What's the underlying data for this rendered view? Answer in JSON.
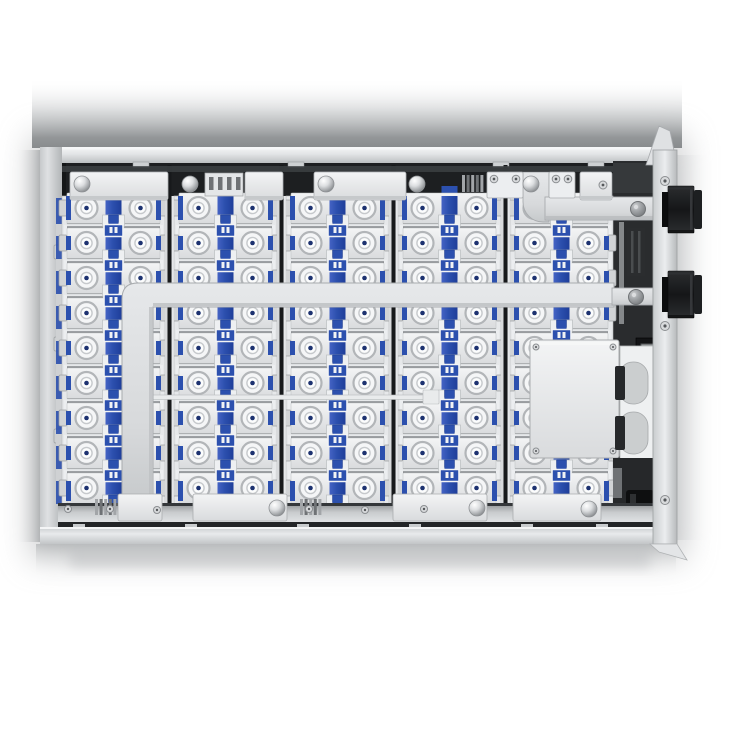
{
  "scene": {
    "subject": "ev-battery-pack-module-top-view-render",
    "background": "#ffffff",
    "palette": {
      "blue": "#2c50ae",
      "blueDark": "#1f3c8c",
      "navyDot": "#1d3270",
      "dark": "#1d1f21",
      "darkPanel": "#2a2c2e",
      "black": "#121314",
      "cellBase": "#e6e8ea",
      "cellPlateStroke": "#c2c5c7",
      "tab": "#d2d4d6",
      "tabEdge": "#9da0a2",
      "sepLight": "#d8dadc",
      "sepDark": "#17191b",
      "barLight": "#dcdee0",
      "seam": "#aeb1b3",
      "coverEdge": "#a8abae",
      "boxStroke": "#aaadaf",
      "screwFill": "#d8dadc",
      "screwEdge": "#8b8e91",
      "wallStroke": "#9da0a2",
      "highlight": "#f2f3f4",
      "cupFill": "#eef0f2",
      "cupStroke": "#bfc2c4"
    },
    "geometry": {
      "canvas": 730,
      "enclosure": {
        "left": 40,
        "top": 147,
        "topWallH": 16,
        "leftWallW": 22,
        "lipY": 527,
        "bottom": 544,
        "rightWallX": 653,
        "rightWallW": 24
      },
      "interior": {
        "x": 58,
        "y": 161,
        "w": 597,
        "h": 366
      },
      "columns": {
        "count": 5,
        "left": 62,
        "width": 103,
        "gap": 9,
        "pitch": 112
      },
      "rows": {
        "count": 9,
        "firstY": 208,
        "pitch": 35
      },
      "terminal": {
        "offset": 27,
        "rOuter": 11,
        "rMid": 5.6,
        "rDot": 2.3
      },
      "strap": {
        "width": 16,
        "top": 196,
        "bottom": 500
      },
      "bar": {
        "offsetFromRow": 18,
        "height": 9
      }
    },
    "components": {
      "top_gap_tabs_x": [
        133,
        288,
        493,
        588
      ],
      "left_wall_tabs_y": [
        252,
        344,
        436
      ],
      "top_rail_items": [
        {
          "t": "plate",
          "x": 70,
          "w": 98
        },
        {
          "t": "dome",
          "x": 82,
          "y": 184
        },
        {
          "t": "dome",
          "x": 190,
          "y": 184
        },
        {
          "t": "clamp",
          "x": 205,
          "w": 38
        },
        {
          "t": "plate",
          "x": 245,
          "w": 38
        },
        {
          "t": "plate",
          "x": 314,
          "w": 92
        },
        {
          "t": "dome",
          "x": 326,
          "y": 184
        },
        {
          "t": "dome",
          "x": 417,
          "y": 184
        },
        {
          "t": "ribs",
          "x": 462,
          "w": 23
        },
        {
          "t": "clamp2",
          "x": 487,
          "w": 36
        },
        {
          "t": "dome",
          "x": 531,
          "y": 184
        },
        {
          "t": "clamp2",
          "x": 549,
          "w": 26
        },
        {
          "t": "plate",
          "x": 580,
          "w": 32
        },
        {
          "t": "screw",
          "x": 603,
          "y": 185
        }
      ],
      "bottom_rail": {
        "plates": [
          {
            "x": 118,
            "w": 44
          },
          {
            "x": 193,
            "w": 94
          },
          {
            "x": 393,
            "w": 94
          },
          {
            "x": 513,
            "w": 88
          }
        ],
        "domes": [
          [
            277,
            508
          ],
          [
            477,
            508
          ],
          [
            589,
            509
          ]
        ],
        "ribs": [
          95,
          300
        ],
        "screws": [
          [
            68,
            509
          ],
          [
            110,
            509
          ],
          [
            157,
            510
          ],
          [
            309,
            509
          ],
          [
            365,
            510
          ],
          [
            424,
            509
          ]
        ],
        "feet": [
          73,
          185,
          297,
          409,
          521,
          596
        ]
      },
      "cover_strap": {
        "hx1": 122,
        "hx2": 614,
        "hy": 283,
        "hh": 24,
        "vx": 122,
        "vw": 31,
        "vy2": 505,
        "ext": [
          612,
          288,
          41,
          17
        ],
        "rivet": [
          636,
          297
        ]
      },
      "upper_busbar": {
        "corner": [
          523,
          172,
          26,
          50
        ],
        "strap": [
          545,
          197,
          108,
          23
        ],
        "rivet": [
          638,
          209
        ]
      },
      "harness": {
        "x": 153,
        "y": 395,
        "w": 272,
        "h": 4.5,
        "tab_x": 423
      },
      "junction_box": {
        "x": 530,
        "y": 340,
        "w": 89,
        "h": 118
      },
      "keyhole_panel": {
        "x": 620,
        "y": 346,
        "w": 33,
        "h": 116,
        "notches_y": [
          362,
          412
        ],
        "bars_y": [
          366,
          416
        ]
      },
      "relay": [
        636,
        338,
        26,
        28
      ],
      "right_section": {
        "base": [
          613,
          161,
          42,
          366
        ],
        "top_shelf": [
          613,
          163,
          40,
          30
        ],
        "sliver": [
          619,
          222,
          5,
          102
        ],
        "dark_block": [
          627,
          228,
          18,
          48
        ],
        "bottom_bay": [
          613,
          458,
          42,
          64
        ],
        "black_block": [
          626,
          490,
          28,
          26
        ],
        "gray_bit": [
          613,
          468,
          9,
          30
        ]
      },
      "wall_screws_y": [
        181,
        326,
        500
      ],
      "connectors": [
        {
          "x": 664,
          "y": 186,
          "h": 47
        },
        {
          "x": 664,
          "y": 271,
          "h": 47
        }
      ],
      "top_flap": "M646 165 L659 126 L670 131 L677 165 Z",
      "bottom_flap": "M650 544 L677 544 L687 560 L659 552 Z"
    }
  }
}
